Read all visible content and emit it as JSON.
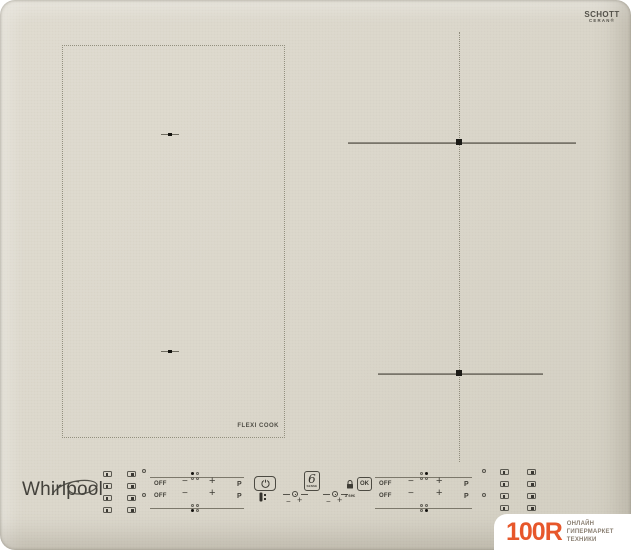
{
  "branding": {
    "schott_name": "SCHOTT",
    "schott_sub": "CERAN®",
    "whirlpool": "Whirlpool"
  },
  "surface": {
    "flexi_label": "FLEXI COOK"
  },
  "controls": {
    "off": "OFF",
    "minus": "−",
    "plus": "+",
    "boost": "P",
    "sense_digit": "6",
    "sense_caption": "SENSE",
    "lock_hint": "3 sec",
    "ok": "OK"
  },
  "watermark": {
    "logo": "100R",
    "tagline": [
      "ОНЛАЙН",
      "ГИПЕРМАРКЕТ",
      "ТЕХНИКИ"
    ],
    "accent_color": "#e7572b"
  },
  "colors": {
    "canvas": "#ffffff",
    "surface": "#dcd8cc",
    "line": "#7c786b",
    "marker": "#14130f",
    "text": "#3f3d36"
  },
  "icons": {
    "power": "power-icon",
    "clock": "timer-clock-icon",
    "key": "key-lock-icon",
    "padlock": "control-lock-icon",
    "zone_select": "zone-select-icon",
    "swirl": "whirlpool-swirl-icon",
    "burner_marker": "burner-center-marker"
  }
}
